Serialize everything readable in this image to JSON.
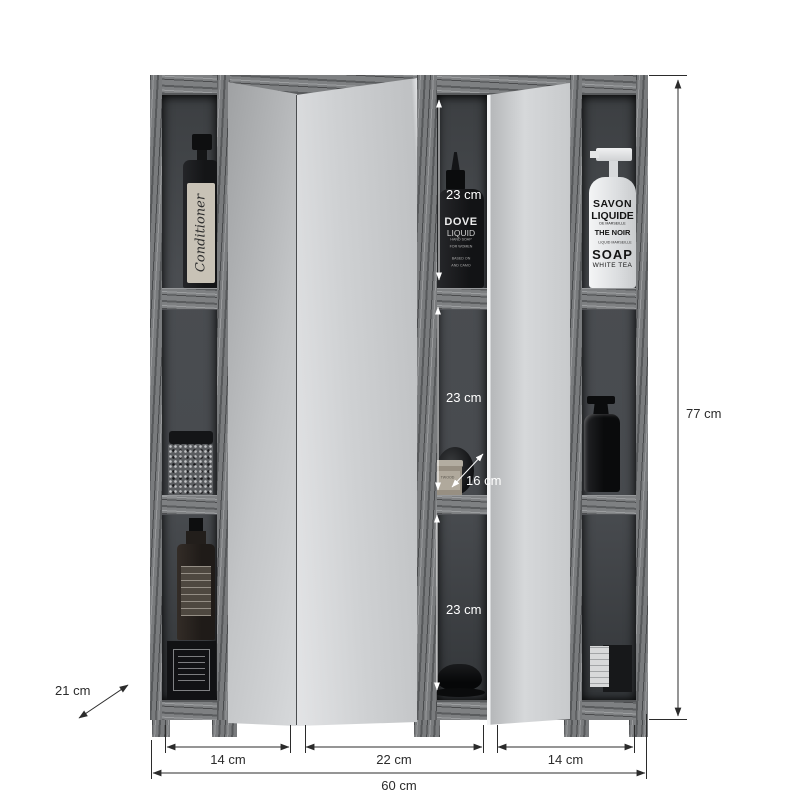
{
  "dimensions": {
    "total_height": "77 cm",
    "total_width": "60 cm",
    "depth": "21 cm",
    "section_left_width": "14 cm",
    "section_middle_width": "22 cm",
    "section_right_width": "14 cm",
    "compartment_top_height": "23 cm",
    "compartment_middle_height": "23 cm",
    "compartment_bottom_height": "23 cm",
    "compartment_depth": "16 cm"
  },
  "products": {
    "conditioner_label": "Conditioner",
    "dove": {
      "brand": "DOVE",
      "type": "LIQUID",
      "sub1": "HAND SOAP",
      "sub2": "FOR WOMEN",
      "sub3": "BASED ON",
      "sub4": "AND CAMO"
    },
    "savon": {
      "l1": "SAVON",
      "l2": "LIQUIDE",
      "l3": "DE MARSEILLE",
      "l4": "THE NOIR",
      "l5": "LIQUID MARSEILLE",
      "l6": "SOAP",
      "l7": "WHITE TEA"
    },
    "jar_label": "TWOOD"
  },
  "colors": {
    "background": "#ffffff",
    "wood": "#7a7c7e",
    "interior": "#43464a",
    "mirror": "#d3d5d7",
    "dimension_line": "#2b2b2b",
    "dimension_text_inside": "#ffffff"
  }
}
